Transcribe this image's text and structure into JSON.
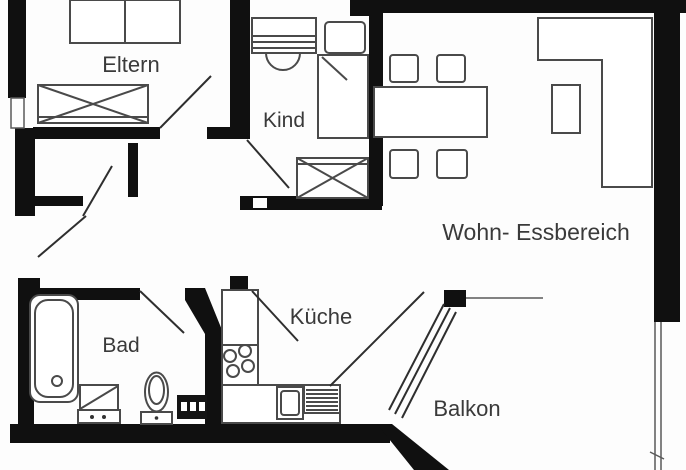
{
  "plan": {
    "type": "apartment-floorplan",
    "rooms": [
      {
        "id": "eltern",
        "label": "Eltern"
      },
      {
        "id": "kind",
        "label": "Kind"
      },
      {
        "id": "wohn",
        "label": "Wohn- Essbereich"
      },
      {
        "id": "bad",
        "label": "Bad"
      },
      {
        "id": "kueche",
        "label": "Küche"
      },
      {
        "id": "balkon",
        "label": "Balkon"
      }
    ],
    "symbols": [
      "double-bed",
      "wardrobe-crossed",
      "child-bed",
      "dresser",
      "desk-chair",
      "dining-table",
      "dining-chairs",
      "corner-sofa",
      "side-table",
      "bathtub",
      "toilet",
      "vanity",
      "washing-machine",
      "tall-cabinet",
      "stove-4-burners",
      "kitchen-sink",
      "drainer",
      "sliding-balcony-door",
      "door-swings",
      "balcony-railing"
    ],
    "colors": {
      "wall": "#101010",
      "furniture_stroke": "#4a4a4a",
      "label": "#3a3a3a",
      "background": "#fdfdfd"
    }
  }
}
